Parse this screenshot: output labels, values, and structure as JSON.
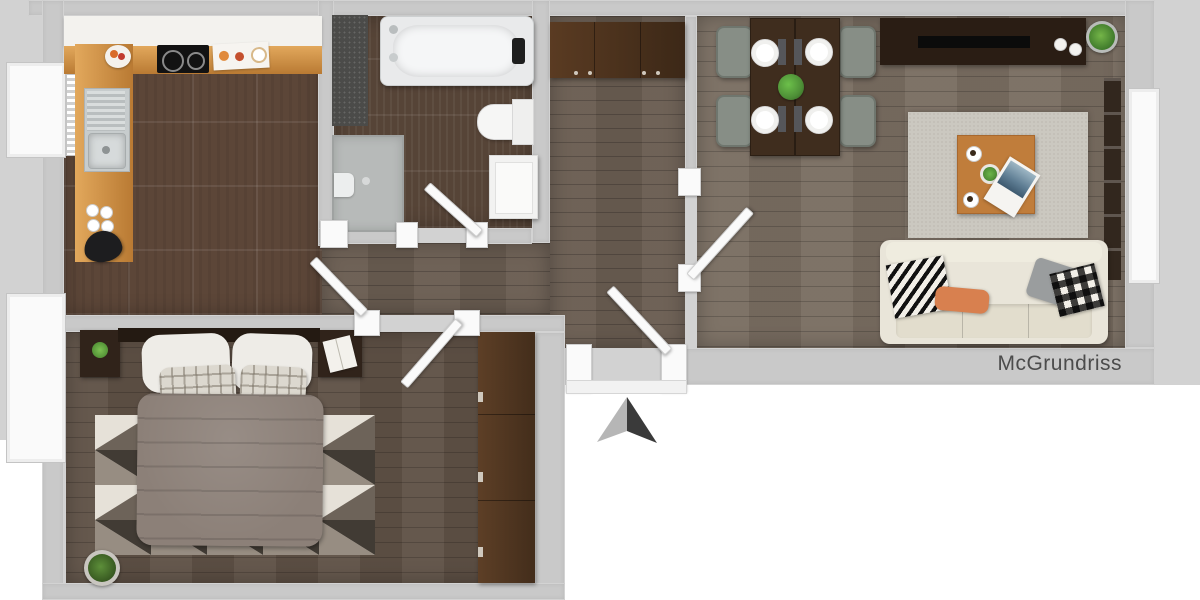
{
  "watermark": {
    "text": "McGrundriss"
  },
  "compass": {
    "type": "north-arrow"
  },
  "palette": {
    "bg": "#d2d2d2",
    "outside_white": "#ffffff",
    "wall": "#c9c9c9",
    "kitchen_floor": "#5c4638",
    "kitchen_wood": "#b97a33",
    "kitchen_wood_light": "#e2a85c",
    "cabinet_white": "#f3f2ee",
    "bath_floor": "#564437",
    "hall_floor": "#6a5d52",
    "living_floor": "#796d61",
    "bedroom_floor": "#5f5146",
    "table_wood": "#3f2d1e",
    "sideboard_wood": "#2a1d14",
    "wardrobe_wood": "#553a23",
    "chair_gray": "#878e86",
    "fixture_white": "#f2f2f1",
    "tub_gray": "#e9eaeb",
    "shower_gray": "#b7bab9",
    "mat_dark": "#4b4b49",
    "rug_living": "#cbc8c0",
    "rug_bed": "#b3aba0",
    "sofa_cream": "#e9e5d9",
    "duvet": "#8c8078",
    "pillow_orange": "#d8804f",
    "pillow_gray": "#9a9d9e",
    "coffee_table": "#c07d3b",
    "plant_green": "#4e8f37",
    "door_white": "#fafafa",
    "arrow_light": "#b6b6b6",
    "arrow_dark": "#3a3a3a",
    "text": "#4c4c4c"
  },
  "rooms": {
    "kitchen": {
      "items": [
        "upper-cabinets",
        "countertop",
        "cooktop",
        "sink",
        "fruit-bowl",
        "cutting-board",
        "espresso-cups",
        "kettle",
        "radiator",
        "window"
      ]
    },
    "bathroom": {
      "items": [
        "bathtub",
        "shower",
        "toilet",
        "washing-machine",
        "bath-mat",
        "door"
      ]
    },
    "hall": {
      "items": [
        "wardrobe",
        "entrance-door",
        "doors"
      ]
    },
    "dining": {
      "items": [
        "dining-table",
        "four-chairs",
        "four-plates",
        "napkins",
        "centerpiece-plant"
      ]
    },
    "living": {
      "items": [
        "tv-sideboard",
        "potted-plant",
        "rug",
        "coffee-table",
        "magazine",
        "sofa",
        "cushions",
        "curtain",
        "balcony-door"
      ]
    },
    "bedroom": {
      "items": [
        "double-bed",
        "nightstands",
        "wardrobe",
        "geometric-rug",
        "potted-plant",
        "window",
        "door"
      ]
    }
  }
}
